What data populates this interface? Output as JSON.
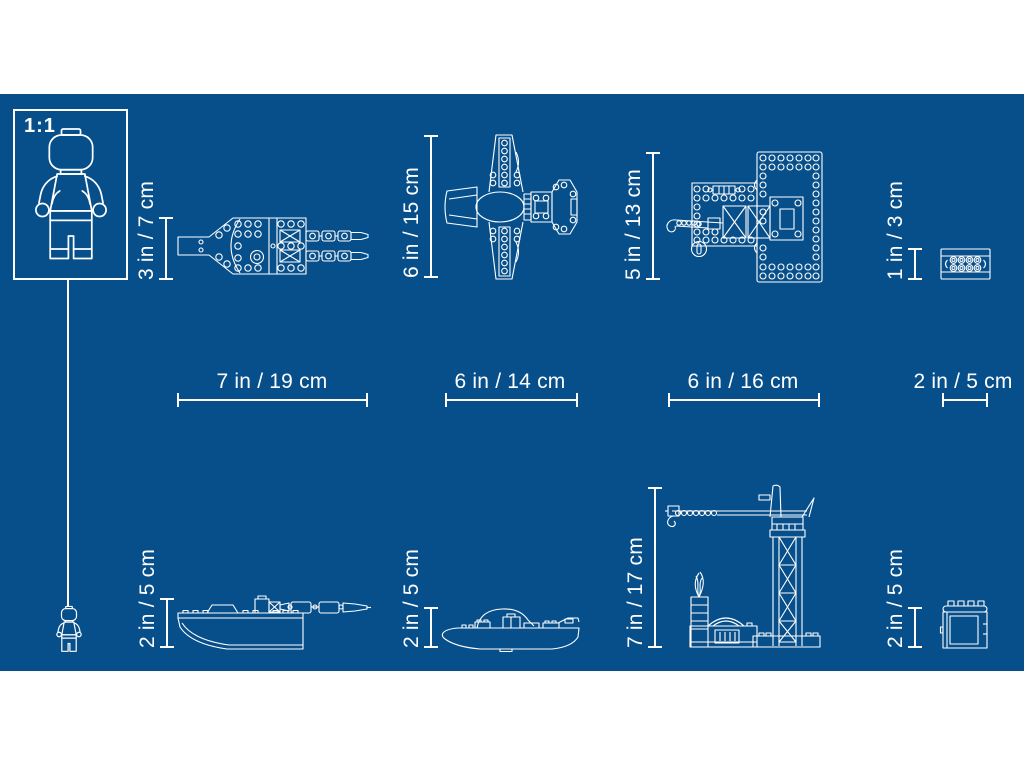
{
  "image_type": "product-dimensions-blueprint",
  "colors": {
    "page_background": "#FFFFFF",
    "blueprint_blue": "#074F8B",
    "line_white": "#FFFFFF"
  },
  "scale_reference": {
    "label": "1:1",
    "figure": "lego-minifigure"
  },
  "models": [
    {
      "name": "shuttle-top-view",
      "height_label": "3 in / 7 cm",
      "width_label": "7 in / 19 cm"
    },
    {
      "name": "jet-plane-top-view",
      "height_label": "6 in / 15 cm",
      "width_label": "6 in / 14 cm"
    },
    {
      "name": "launch-platform-top-view",
      "height_label": "5 in / 13 cm",
      "width_label": "6 in / 16 cm"
    },
    {
      "name": "small-brick-top-view",
      "height_label": "1 in / 3 cm",
      "width_label": "2 in / 5 cm"
    },
    {
      "name": "boat-side-view",
      "height_label": "2 in / 5 cm"
    },
    {
      "name": "submarine-side-view",
      "height_label": "2 in / 5 cm"
    },
    {
      "name": "crane-tower-side-view",
      "height_label": "7 in / 17 cm"
    },
    {
      "name": "storage-box-side-view",
      "height_label": "2 in / 5 cm"
    }
  ]
}
